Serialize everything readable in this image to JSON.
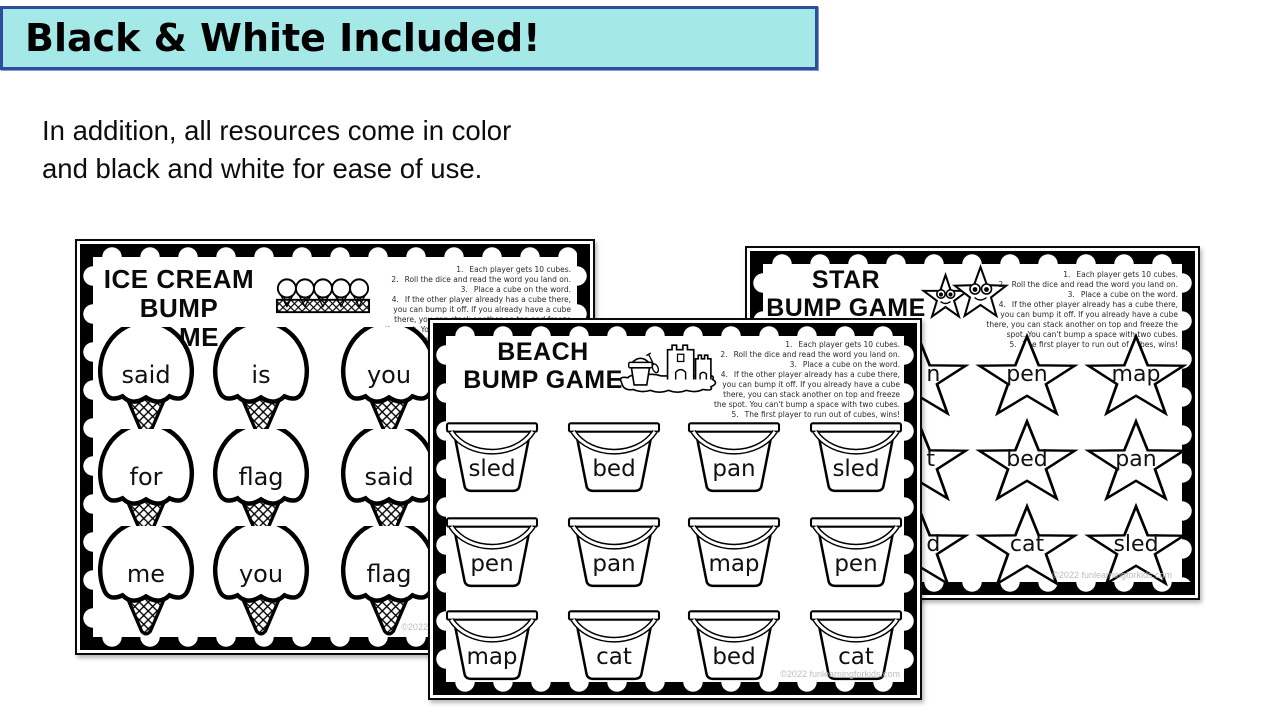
{
  "banner": {
    "title": "Black & White Included!",
    "bg_color": "#a5e8e8",
    "border_color": "#2e4e9b"
  },
  "intro": {
    "line1": "In addition, all resources come in color",
    "line2": "and black and white for ease of use."
  },
  "shared_instructions": [
    {
      "num": "1.",
      "text": "Each player gets 10 cubes."
    },
    {
      "num": "2.",
      "text": "Roll the dice and read the word you land on."
    },
    {
      "num": "3.",
      "text": "Place a cube on the word."
    },
    {
      "num": "4.",
      "text": "If the other player already has a cube there, you can bump it off. If you already have a cube there, you can stack another on top and freeze the spot. You can't bump a space with two cubes."
    },
    {
      "num": "5.",
      "text": "The first player to run out of cubes, wins!"
    }
  ],
  "cards": {
    "icecream": {
      "title1": "ICE CREAM",
      "title2": "BUMP GAME",
      "icon": "ice-cream-cone-icon",
      "header_icon": "ice-cream-tray-illustration",
      "words": [
        "said",
        "is",
        "you",
        "for",
        "flag",
        "said",
        "me",
        "you",
        "flag"
      ],
      "watermark": "©2022 funlearningforkids.com"
    },
    "beach": {
      "title1": "BEACH",
      "title2": "BUMP GAME",
      "icon": "sand-bucket-icon",
      "header_icon": "sandcastle-beach-illustration",
      "words": [
        "sled",
        "bed",
        "pan",
        "sled",
        "pen",
        "pan",
        "map",
        "pen",
        "map",
        "cat",
        "bed",
        "cat"
      ],
      "watermark": "©2022 funlearningforkids.com"
    },
    "star": {
      "title1": "STAR",
      "title2": "BUMP GAME",
      "icon": "star-icon",
      "header_icon": "smiling-stars-illustration",
      "words": [
        "pen",
        "map",
        "bed",
        "pan",
        "cat",
        "sled"
      ],
      "partial_letters": [
        "n",
        "t",
        "d"
      ],
      "watermark": "©2022 funlearningforkids.com"
    }
  }
}
